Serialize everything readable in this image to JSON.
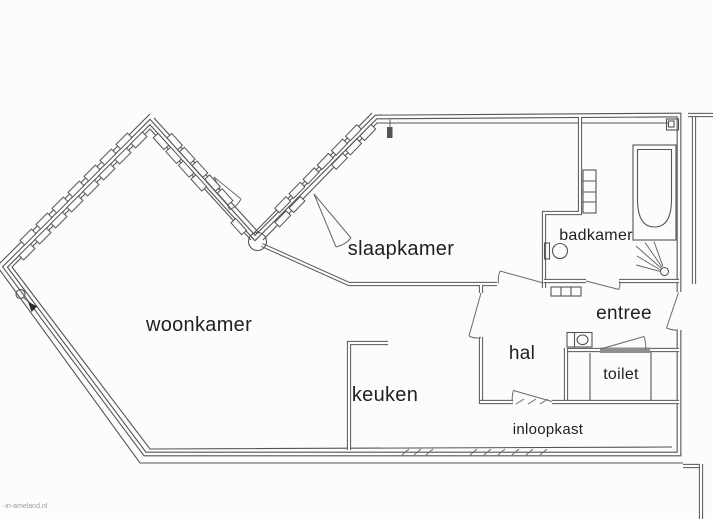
{
  "labels": {
    "woonkamer": "woonkamer",
    "slaapkamer": "slaapkamer",
    "badkamer": "badkamer",
    "entree": "entree",
    "hal": "hal",
    "keuken": "keuken",
    "toilet": "toilet",
    "inloopkast": "inloopkast"
  },
  "watermark": "-in-ameland.nl",
  "colors": {
    "line": "#555555",
    "background": "#fcfcfc",
    "label": "#1f1f1f",
    "door": "#8f8f8f"
  }
}
